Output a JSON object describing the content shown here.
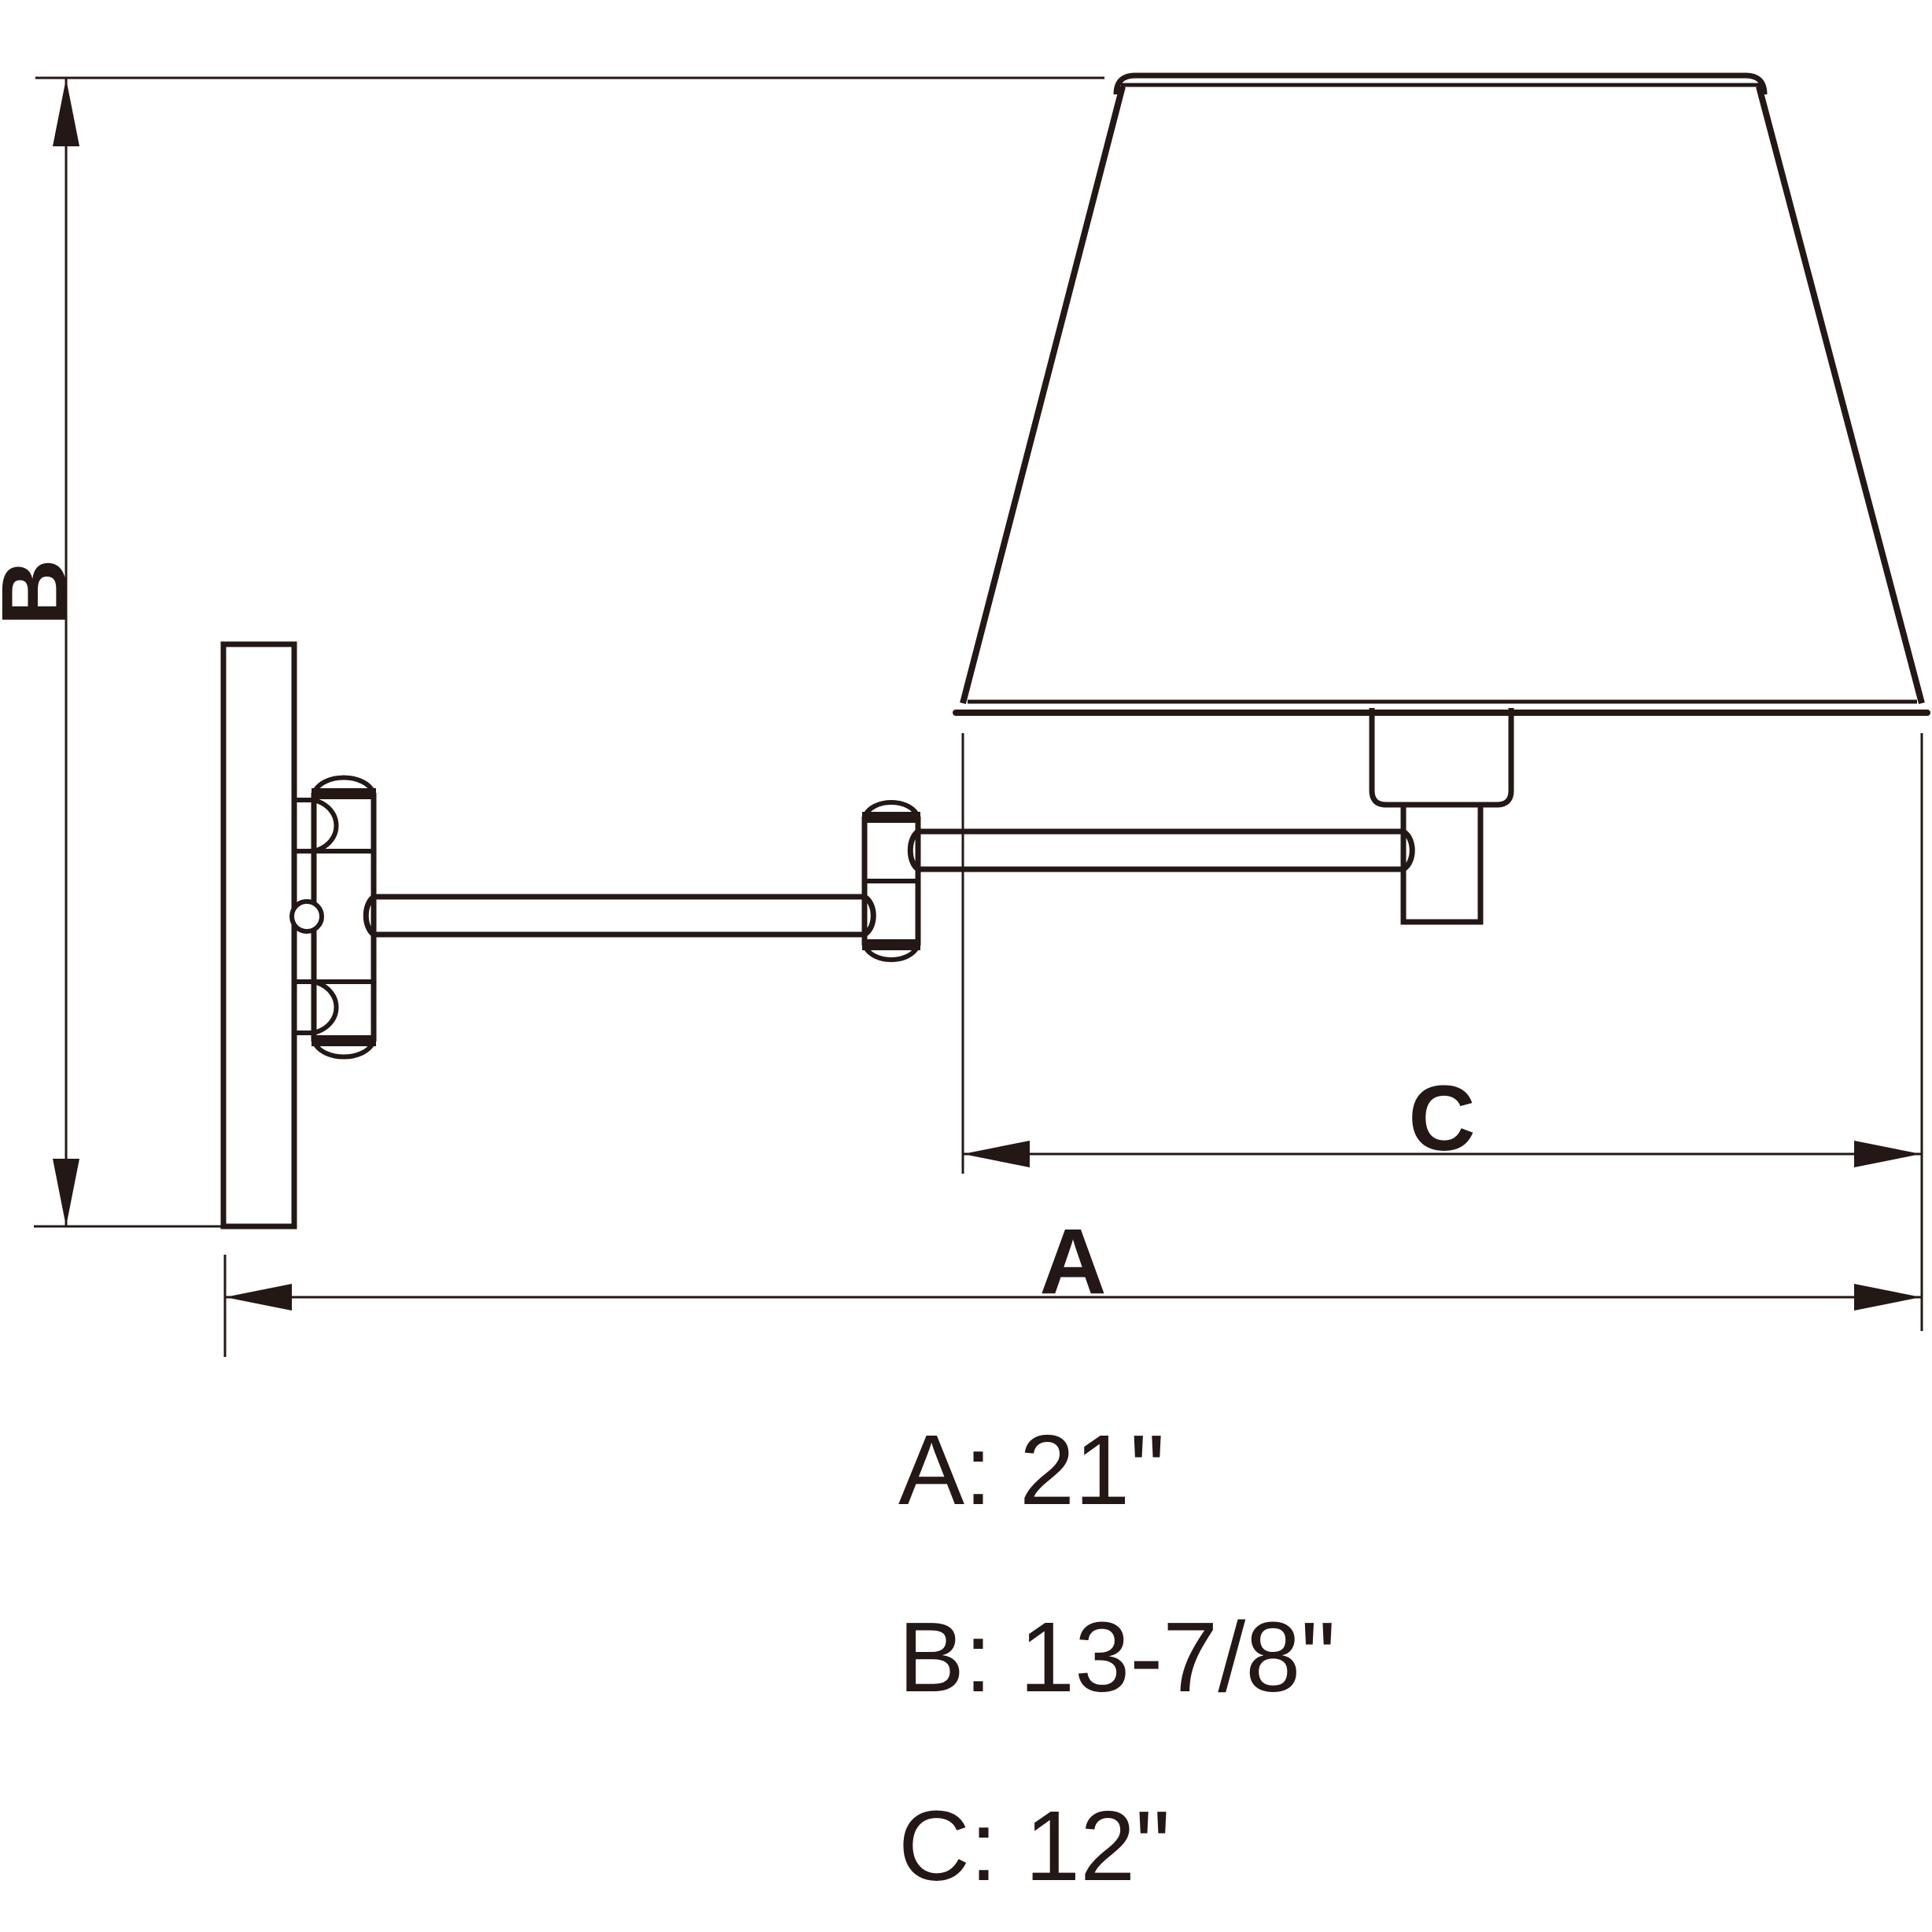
{
  "meta": {
    "title": "Swing-arm wall sconce dimension drawing",
    "background_color": "#ffffff",
    "line_color": "#231815"
  },
  "dimensions": {
    "A": {
      "label": "A",
      "value": "21\""
    },
    "B": {
      "label": "B",
      "value": "13-7/8\""
    },
    "C": {
      "label": "C",
      "value": "12\""
    }
  },
  "spec_list": [
    "A: 21\"",
    "B: 13-7/8\"",
    "C: 12\""
  ]
}
